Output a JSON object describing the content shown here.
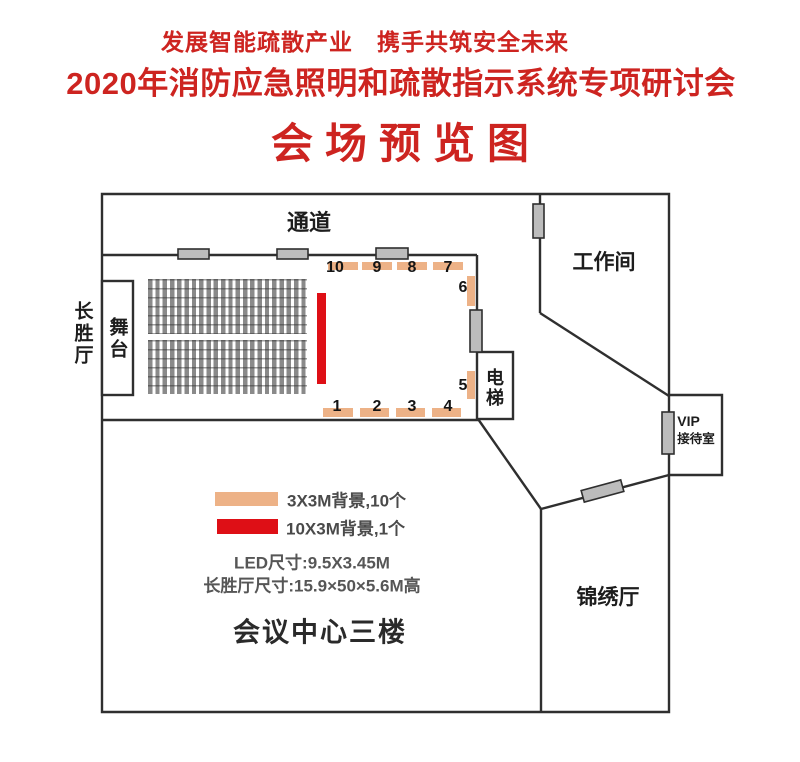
{
  "header": {
    "slogan": "发展智能疏散产业　携手共筑安全未来",
    "title": "2020年消防应急照明和疏散指示系统专项研讨会",
    "subtitle": "会场预览图"
  },
  "rooms": {
    "corridor": "通道",
    "workroom": "工作间",
    "stage": "舞台",
    "hall_name": "长胜厅",
    "elevator": "电梯",
    "vip_line1": "VIP",
    "vip_line2": "接待室",
    "jinxiu_hall": "锦绣厅",
    "floor_label": "会议中心三楼"
  },
  "markers": {
    "top": [
      "10",
      "9",
      "8",
      "7"
    ],
    "right": [
      "6",
      "5"
    ],
    "bottom": [
      "1",
      "2",
      "3",
      "4"
    ]
  },
  "legend": {
    "orange_label": "3X3M背景,10个",
    "red_label": "10X3M背景,1个",
    "led_size": "LED尺寸:9.5X3.45M",
    "hall_size": "长胜厅尺寸:15.9×50×5.6M高"
  },
  "colors": {
    "title_red": "#cd2420",
    "marker_orange": "#edb287",
    "banner_red": "#de0f16",
    "wall_dark": "#2f2f2f",
    "door_gray": "#bcbcbc"
  }
}
